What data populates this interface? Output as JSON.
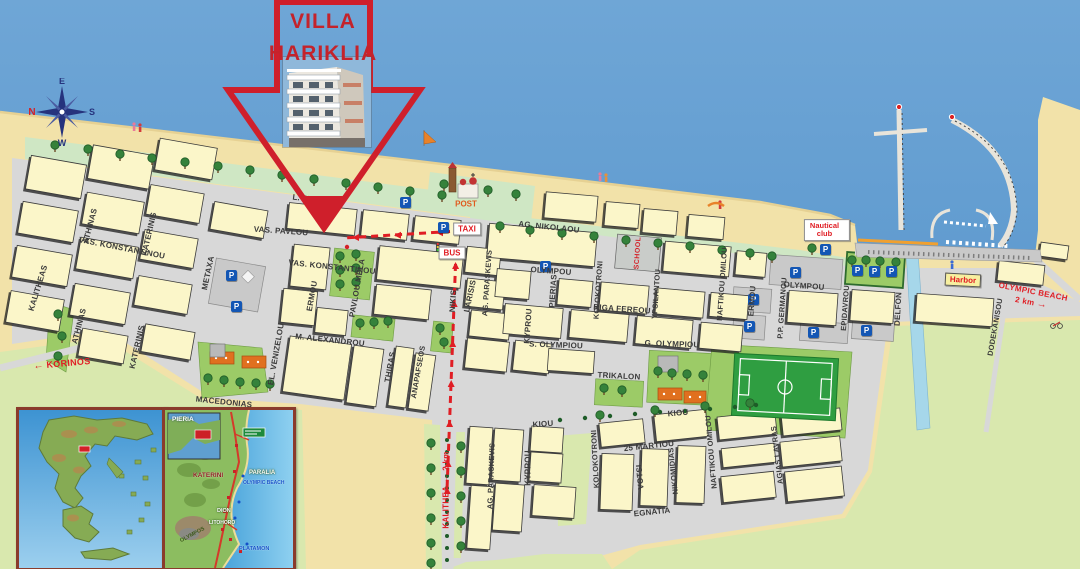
{
  "title": {
    "line1": "VILLA",
    "line2": "HARIKLIA"
  },
  "compass": {
    "north": "N",
    "east": "E",
    "south": "S",
    "west": "W"
  },
  "icons": {
    "arrow_left": "←",
    "arrow_right": "→",
    "parking": "P"
  },
  "streets": [
    "L. STRATOU",
    "VAS. PAVLOU",
    "AG. NIKOLAOU",
    "VAS. KONSTANTINOU",
    "VAS. KONSTANTINOU",
    "M. ALEXANDROU",
    "MACEDONIAS",
    "OLYMPOU",
    "OLYMPOU",
    "RIGA FEREOU",
    "S. OLYMPIOU",
    "G. OLYMPIOU",
    "TRIKALON",
    "KIOU",
    "KIOU",
    "25 MARTIOU",
    "EGNATIA",
    "KALITHEAS",
    "ATHINAS",
    "ATHINAS",
    "KATERINIS",
    "KATERINIS",
    "METAXA",
    "EL. VENIZELOU",
    "ERMOU",
    "PAVLOU MELA",
    "NIKIS",
    "LARISIS",
    "AG. PARASKEVIS",
    "AG. PARASKEVIS",
    "KYPROU",
    "KYPROU",
    "PIERIAS",
    "KOLOKOTRONI",
    "KOLOKOTRONI",
    "YPSILANTOU",
    "NAFTIKOU OMILOU",
    "NAFTIKOU OMILOU",
    "VOTSI",
    "NIKOMIDIAS",
    "AGIAS LAVRAS",
    "THIRAS",
    "ANAPAFSEOS",
    "ERMOU",
    "P.P. GERMANOU",
    "EPIDAVROU",
    "DELFON",
    "DODEKANISOU"
  ],
  "pois": {
    "post": "POST",
    "taxi": "TAXI",
    "bus": "BUS",
    "school": "SCHOOL",
    "nautical_club_line1": "Nautical",
    "nautical_club_line2": "club",
    "harbor": "Harbor"
  },
  "directions": {
    "korinos": "KORINOS",
    "kalithea": "KALITHEA",
    "kalithea_distance": "2 km",
    "olympic_beach": "OLYMPIC BEACH",
    "olympic_beach_distance": "2 km"
  },
  "insets": {
    "pieria": {
      "region_label": "PIERIA",
      "places": [
        "KATERINI",
        "PARALIA",
        "OLYMPIC BEACH",
        "DION",
        "LITOHORO",
        "OLYMPOS",
        "PLATAMON"
      ]
    }
  },
  "colors": {
    "sea": "#5796ce",
    "sand": "#f2e2a9",
    "block": "#fbf6c9",
    "road": "#d8d8d8",
    "park": "#9ccb67",
    "field": "#d9e8ae",
    "route_red": "#e01d24",
    "accent_red": "#c4232b"
  }
}
